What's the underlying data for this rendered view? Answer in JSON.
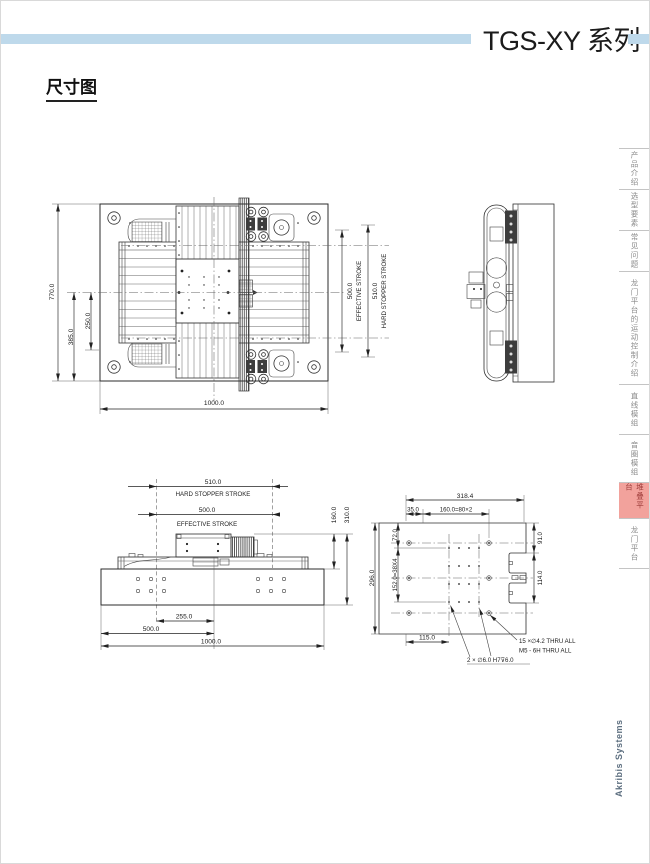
{
  "header": {
    "title": "TGS-XY 系列",
    "accent_color": "#BED9EB"
  },
  "section": {
    "title": "尺寸图"
  },
  "sidebar": {
    "active_bg": "#F2A29C",
    "active_text_color": "#9C3B38",
    "tabs": [
      {
        "label": "产品介绍",
        "active": false
      },
      {
        "label": "选型要素",
        "active": false
      },
      {
        "label": "常见问题",
        "active": false
      },
      {
        "label": "龙门平台的运动控制介绍",
        "active": false
      },
      {
        "label": "直线模组",
        "active": false
      },
      {
        "label": "音圈模组",
        "active": false
      },
      {
        "label": "堆叠平台",
        "active": true
      },
      {
        "label": "龙门平台",
        "active": false
      }
    ]
  },
  "footer": {
    "brand": "Akribis Systems"
  },
  "drawings": {
    "plan": {
      "dim_height": "770.0",
      "dim_center_to_bottom": "385.0",
      "dim_inner": "250.0",
      "dim_width": "1000.0",
      "effective_stroke_value": "500.0",
      "effective_stroke_label": "EFFECTIVE STROKE",
      "hard_stopper_value": "510.0",
      "hard_stopper_label": "HARD STOPPER STROKE"
    },
    "front": {
      "hard_stopper_value": "510.0",
      "hard_stopper_label": "HARD STOPPER STROKE",
      "effective_stroke_value": "500.0",
      "effective_stroke_label": "EFFECTIVE STROKE",
      "dim_carriage_height": "160.0",
      "dim_total_height": "310.0",
      "dim_carriage_pos": "255.0",
      "dim_half_width": "500.0",
      "dim_width": "1000.0"
    },
    "plate": {
      "dim_width_overall": "318.4",
      "dim_edge": "35.0",
      "dim_hole_pitch_h": "160.0=80×2",
      "dim_height_overall": "296.0",
      "dim_top_offset": "72.0",
      "dim_hole_pitch_v": "152.0=38X4",
      "dim_right_top": "91.0",
      "dim_slot": "114.0",
      "dim_bottom": "115.0",
      "note_thru_line1": "15 ×∅4.2 THRU ALL",
      "note_thru_line2": "M5 - 6H THRU ALL",
      "note_dowel": "2 × ∅6.0 H7⊽6.0"
    }
  }
}
